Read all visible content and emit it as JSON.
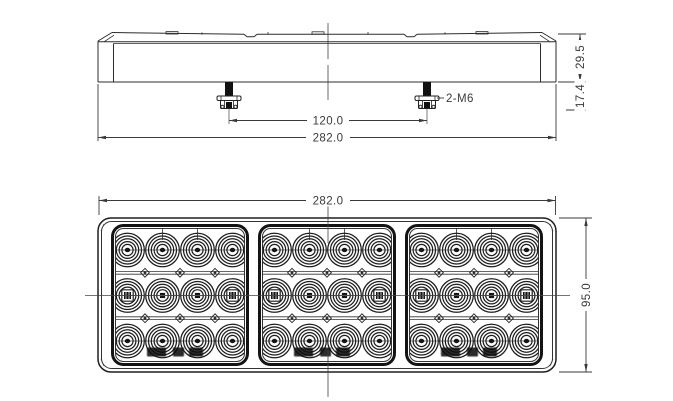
{
  "meta": {
    "title": "LED combination lamp engineering drawing, side view and front view",
    "background_color": "#ffffff",
    "line_color": "#2c2c2c"
  },
  "top_view": {
    "name": "side-elevation-view",
    "dim_bolt_spacing": "120.0",
    "dim_overall_width": "282.0",
    "bolt_callout": "2-M6",
    "dim_total_height": "29.5",
    "dim_stud_length": "17.4"
  },
  "front_view": {
    "name": "front-face-view",
    "dim_overall_width": "282.0",
    "dim_overall_height": "95.0"
  },
  "drawing": {
    "sections": 3,
    "led_columns": 4,
    "led_rows": 3,
    "section_x": [
      111,
      258,
      405
    ],
    "section_width": 138,
    "section_top": 224,
    "section_height": 142,
    "col_offset": 16.5,
    "col_spacing": 35,
    "row_y": [
      250,
      295.5,
      341
    ],
    "separator_y": [
      272.8,
      318.2
    ],
    "ring_radii": [
      16.8,
      14,
      11.2,
      8.4
    ],
    "bolt_centers": [
      229,
      427
    ],
    "lens_border_color": "#141414",
    "ring_color": "#1e1e1e"
  }
}
